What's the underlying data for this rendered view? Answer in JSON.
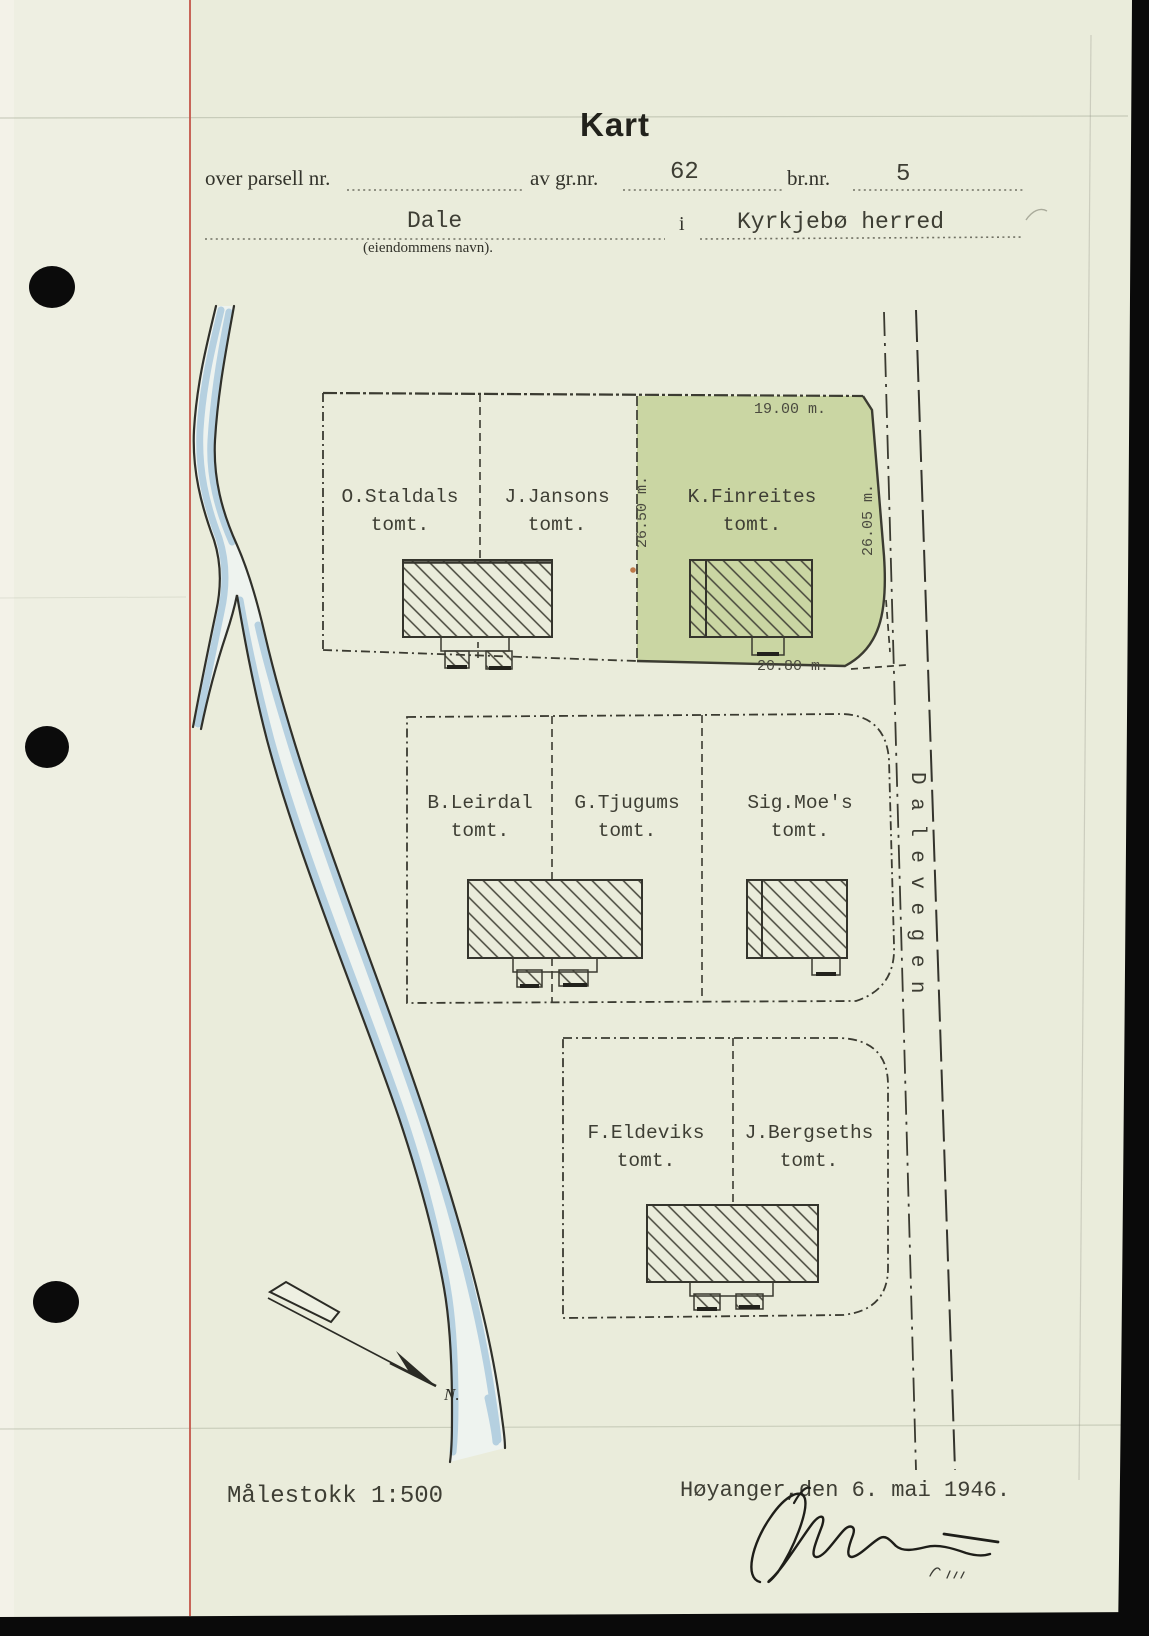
{
  "header": {
    "title": "Kart",
    "field_parcel_label": "over parsell nr.",
    "field_gnr_label": "av gr.nr.",
    "gnr_value": "62",
    "field_bnr_label": "br.nr.",
    "bnr_value": "5",
    "property_name": "Dale",
    "property_caption": "(eiendommens navn).",
    "in_label": "i",
    "district": "Kyrkjebø herred"
  },
  "map": {
    "road_name": "Dalevegen",
    "north_label": "N.",
    "blocks": [
      {
        "parcels": [
          {
            "name": "O.Staldals",
            "suffix": "tomt."
          },
          {
            "name": "J.Jansons",
            "suffix": "tomt."
          },
          {
            "name": "K.Finreites",
            "suffix": "tomt.",
            "highlighted": true
          }
        ],
        "measurements": {
          "top": "19.00 m.",
          "left": "26.50 m.",
          "right": "26.05 m.",
          "bottom": "20.80 m."
        }
      },
      {
        "parcels": [
          {
            "name": "B.Leirdal",
            "suffix": "tomt."
          },
          {
            "name": "G.Tjugums",
            "suffix": "tomt."
          },
          {
            "name": "Sig.Moe's",
            "suffix": "tomt."
          }
        ]
      },
      {
        "parcels": [
          {
            "name": "F.Eldeviks",
            "suffix": "tomt."
          },
          {
            "name": "J.Bergseths",
            "suffix": "tomt."
          }
        ]
      }
    ],
    "colors": {
      "highlight_green": "#c6d49c",
      "river_blue": "#a8c8dd",
      "margin_red": "#c4574a",
      "ink": "#3e3e34"
    }
  },
  "footer": {
    "scale": "Målestokk 1:500",
    "place_date": "Høyanger,den 6. mai 1946."
  }
}
